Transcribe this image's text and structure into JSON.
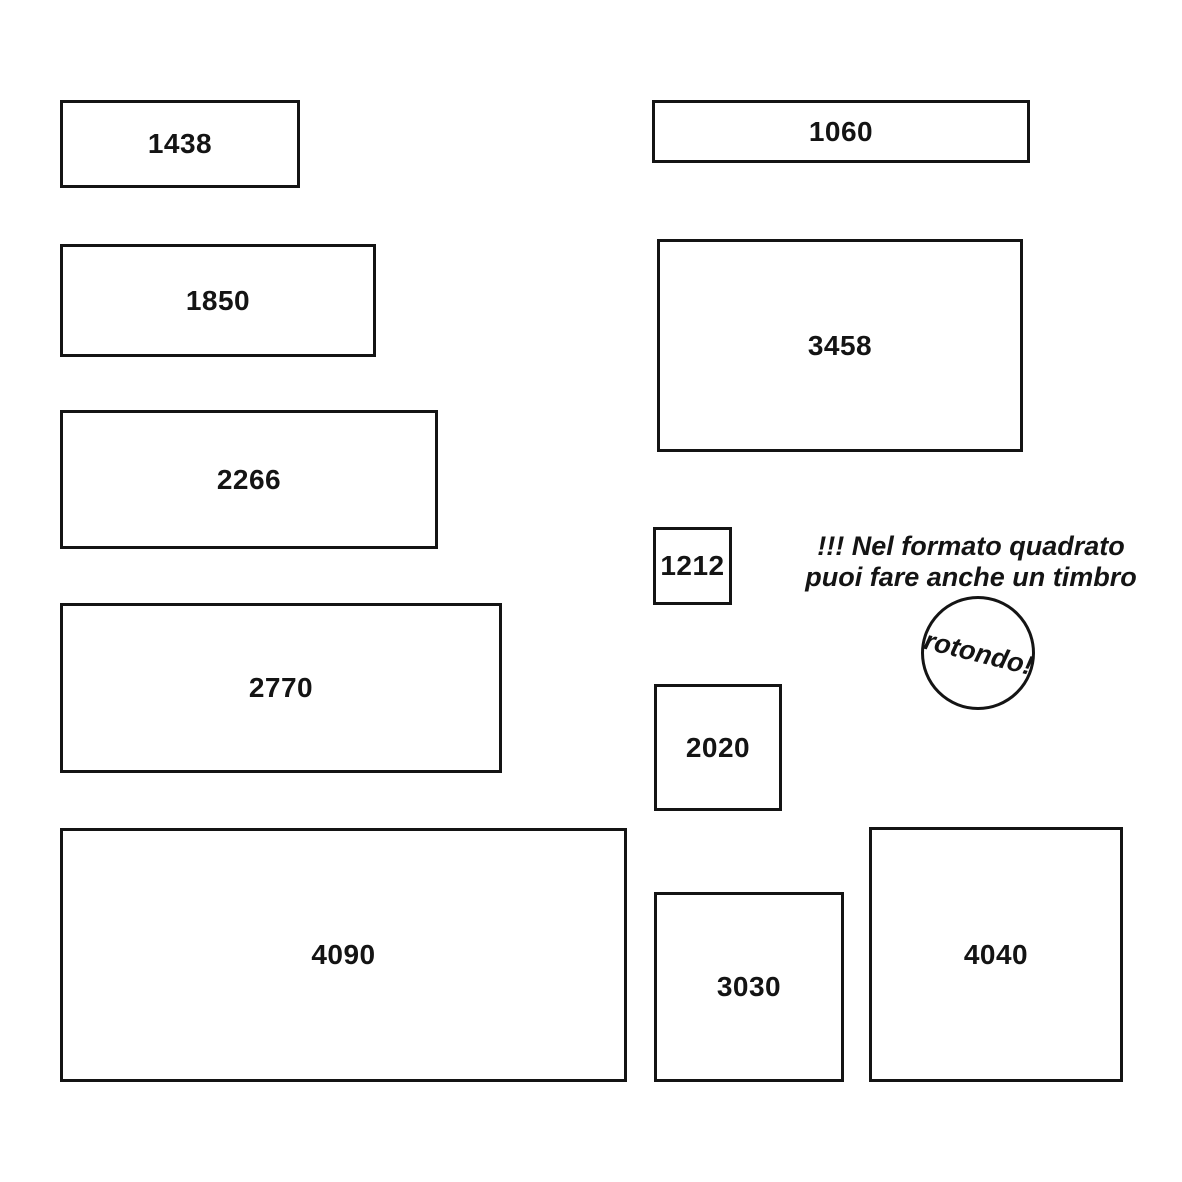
{
  "page": {
    "background_color": "#ffffff",
    "ink_color": "#141414",
    "description_language": "it"
  },
  "formats": [
    {
      "label": "1438"
    },
    {
      "label": "1850"
    },
    {
      "label": "2266"
    },
    {
      "label": "2770"
    },
    {
      "label": "4090"
    },
    {
      "label": "1060"
    },
    {
      "label": "3458"
    },
    {
      "label": "1212"
    },
    {
      "label": "2020"
    },
    {
      "label": "3030"
    },
    {
      "label": "4040"
    }
  ],
  "note": {
    "line1": "!!! Nel formato quadrato",
    "line2": "puoi fare anche un timbro"
  },
  "round_stamp": {
    "label": "rotondo!"
  }
}
